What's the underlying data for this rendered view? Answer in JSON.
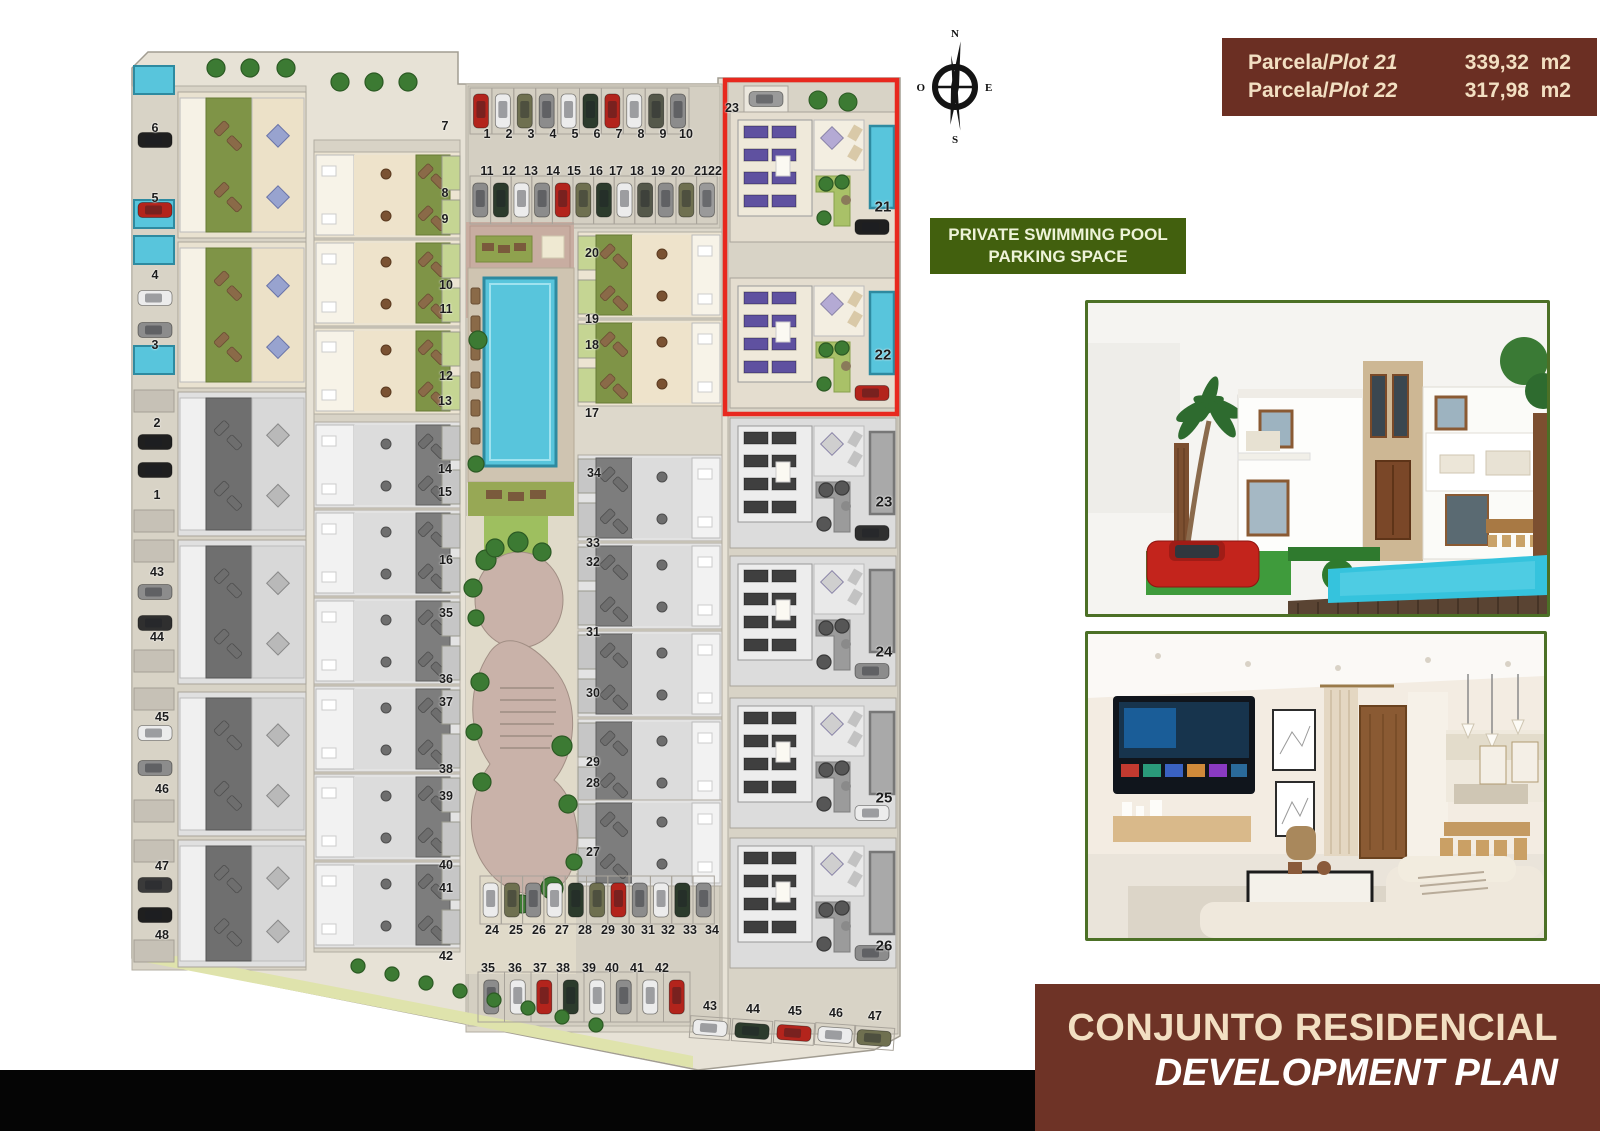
{
  "colors": {
    "highlight_red": "#e8281e",
    "pool_blue": "#58c5dc",
    "lawn_green": "#7f9447",
    "solar_purple": "#5f51a0",
    "tree_green": "#3c7a33",
    "maroon": "#6b2f23",
    "olive_badge": "#42600e",
    "cream_text": "#f2dfc2",
    "banner_maroon": "#6e3326"
  },
  "compass": {
    "n": "N",
    "e": "E",
    "s": "S",
    "o": "O"
  },
  "plot_info": {
    "rows": [
      {
        "prefix": "Parcela/",
        "name": "Plot 21",
        "area": "339,32  m2"
      },
      {
        "prefix": "Parcela/",
        "name": "Plot 22",
        "area": "317,98  m2"
      }
    ]
  },
  "badge": {
    "line1": "PRIVATE SWIMMING POOL",
    "line2": "PARKING SPACE"
  },
  "banner": {
    "line1": "CONJUNTO RESIDENCIAL",
    "line2": "DEVELOPMENT PLAN"
  },
  "site_plan": {
    "highlighted_plots": [
      "21",
      "22"
    ],
    "labels": [
      [
        "1",
        369,
        94
      ],
      [
        "2",
        391,
        94
      ],
      [
        "3",
        413,
        94
      ],
      [
        "4",
        435,
        94
      ],
      [
        "5",
        457,
        94
      ],
      [
        "6",
        479,
        94
      ],
      [
        "7",
        501,
        94
      ],
      [
        "8",
        523,
        94
      ],
      [
        "9",
        545,
        94
      ],
      [
        "10",
        568,
        94
      ],
      [
        "11",
        369,
        131
      ],
      [
        "12",
        391,
        131
      ],
      [
        "13",
        413,
        131
      ],
      [
        "14",
        435,
        131
      ],
      [
        "15",
        456,
        131
      ],
      [
        "16",
        478,
        131
      ],
      [
        "17",
        498,
        131
      ],
      [
        "18",
        519,
        131
      ],
      [
        "19",
        540,
        131
      ],
      [
        "20",
        560,
        131
      ],
      [
        "21",
        583,
        131
      ],
      [
        "22",
        597,
        131
      ],
      [
        "23",
        614,
        68
      ],
      [
        "7",
        327,
        86
      ],
      [
        "8",
        327,
        153
      ],
      [
        "9",
        327,
        179
      ],
      [
        "10",
        328,
        245
      ],
      [
        "11",
        328,
        269
      ],
      [
        "12",
        328,
        336
      ],
      [
        "13",
        327,
        361
      ],
      [
        "14",
        327,
        429
      ],
      [
        "15",
        327,
        452
      ],
      [
        "16",
        328,
        520
      ],
      [
        "35",
        328,
        573
      ],
      [
        "36",
        328,
        639
      ],
      [
        "37",
        328,
        662
      ],
      [
        "38",
        328,
        729
      ],
      [
        "39",
        328,
        756
      ],
      [
        "40",
        328,
        825
      ],
      [
        "41",
        328,
        848
      ],
      [
        "42",
        328,
        916
      ],
      [
        "20",
        474,
        213
      ],
      [
        "19",
        474,
        279
      ],
      [
        "18",
        474,
        305
      ],
      [
        "17",
        474,
        373
      ],
      [
        "34",
        476,
        433
      ],
      [
        "33",
        475,
        503
      ],
      [
        "32",
        475,
        522
      ],
      [
        "31",
        475,
        592
      ],
      [
        "30",
        475,
        653
      ],
      [
        "29",
        475,
        722
      ],
      [
        "28",
        475,
        743
      ],
      [
        "27",
        475,
        812
      ],
      [
        "21",
        765,
        167,
        1
      ],
      [
        "22",
        765,
        315,
        1
      ],
      [
        "23",
        766,
        462,
        1
      ],
      [
        "24",
        766,
        612,
        1
      ],
      [
        "25",
        766,
        758,
        1
      ],
      [
        "26",
        766,
        906,
        1
      ],
      [
        "6",
        37,
        88
      ],
      [
        "5",
        37,
        158
      ],
      [
        "4",
        37,
        235
      ],
      [
        "3",
        37,
        305
      ],
      [
        "2",
        39,
        383
      ],
      [
        "1",
        39,
        455
      ],
      [
        "43",
        39,
        532
      ],
      [
        "44",
        39,
        597
      ],
      [
        "45",
        44,
        677
      ],
      [
        "46",
        44,
        749
      ],
      [
        "47",
        44,
        826
      ],
      [
        "48",
        44,
        895
      ],
      [
        "24",
        374,
        890
      ],
      [
        "25",
        398,
        890
      ],
      [
        "26",
        421,
        890
      ],
      [
        "27",
        444,
        890
      ],
      [
        "28",
        467,
        890
      ],
      [
        "29",
        490,
        890
      ],
      [
        "30",
        510,
        890
      ],
      [
        "31",
        530,
        890
      ],
      [
        "32",
        550,
        890
      ],
      [
        "33",
        572,
        890
      ],
      [
        "34",
        594,
        890
      ],
      [
        "35",
        370,
        928
      ],
      [
        "36",
        397,
        928
      ],
      [
        "37",
        422,
        928
      ],
      [
        "38",
        445,
        928
      ],
      [
        "39",
        471,
        928
      ],
      [
        "40",
        494,
        928
      ],
      [
        "41",
        519,
        928
      ],
      [
        "42",
        544,
        928
      ],
      [
        "43",
        592,
        966
      ],
      [
        "44",
        635,
        969
      ],
      [
        "45",
        677,
        971
      ],
      [
        "46",
        718,
        973
      ],
      [
        "47",
        757,
        976
      ]
    ],
    "parking": {
      "top_row_1": {
        "car_colors": [
          "#b3241c",
          "#ececec",
          "#6f7050",
          "#8c8c8c",
          "#ececec",
          "#2c3b2c",
          "#b3241c",
          "#ececec",
          "#55584a",
          "#8c8c8c"
        ]
      },
      "top_row_2": {
        "car_colors": [
          "#8c8c8c",
          "#2c3b2c",
          "#ececec",
          "#8c8c8c",
          "#b3241c",
          "#6f7050",
          "#2c3b2c",
          "#ececec",
          "#55584a",
          "#8c8c8c",
          "#6f7050",
          "#9a9a9a"
        ]
      },
      "bottom_row_1": {
        "car_colors": [
          "#ececec",
          "#6f7050",
          "#8c8c8c",
          "#ececec",
          "#2c3b2c",
          "#6f7050",
          "#b3241c",
          "#8c8c8c",
          "#ececec",
          "#2c3b2c",
          "#8c8c8c"
        ]
      },
      "bottom_row_2": {
        "car_colors": [
          "#8c8c8c",
          "#ececec",
          "#b3241c",
          "#2c3b2c",
          "#ececec",
          "#8c8c8c",
          "#ececec",
          "#b3241c"
        ]
      },
      "side_row": {
        "car_colors": [
          "#ececec",
          "#2c3b2c",
          "#b3241c",
          "#ececec",
          "#6f7050"
        ]
      },
      "left_strip": {
        "car_colors": [
          "#1f1f1f",
          "#b3241c",
          "#ececec",
          "#8c8c8c",
          "#1f1f1f",
          "#1f1f1f",
          "#8c8c8c",
          "#2f2f2f",
          "#ececec",
          "#8c8c8c",
          "#3a3a3a",
          "#1f1f1f"
        ]
      },
      "spot23_car": "#9a9a9a"
    },
    "right_villas": {
      "colored_car_colors": [
        "#1f1f1f",
        "#b3241c"
      ],
      "gray_car_colors": [
        "#2f2f2f",
        "#8c8c8c",
        "#ececec",
        "#8c8c8c"
      ]
    }
  }
}
